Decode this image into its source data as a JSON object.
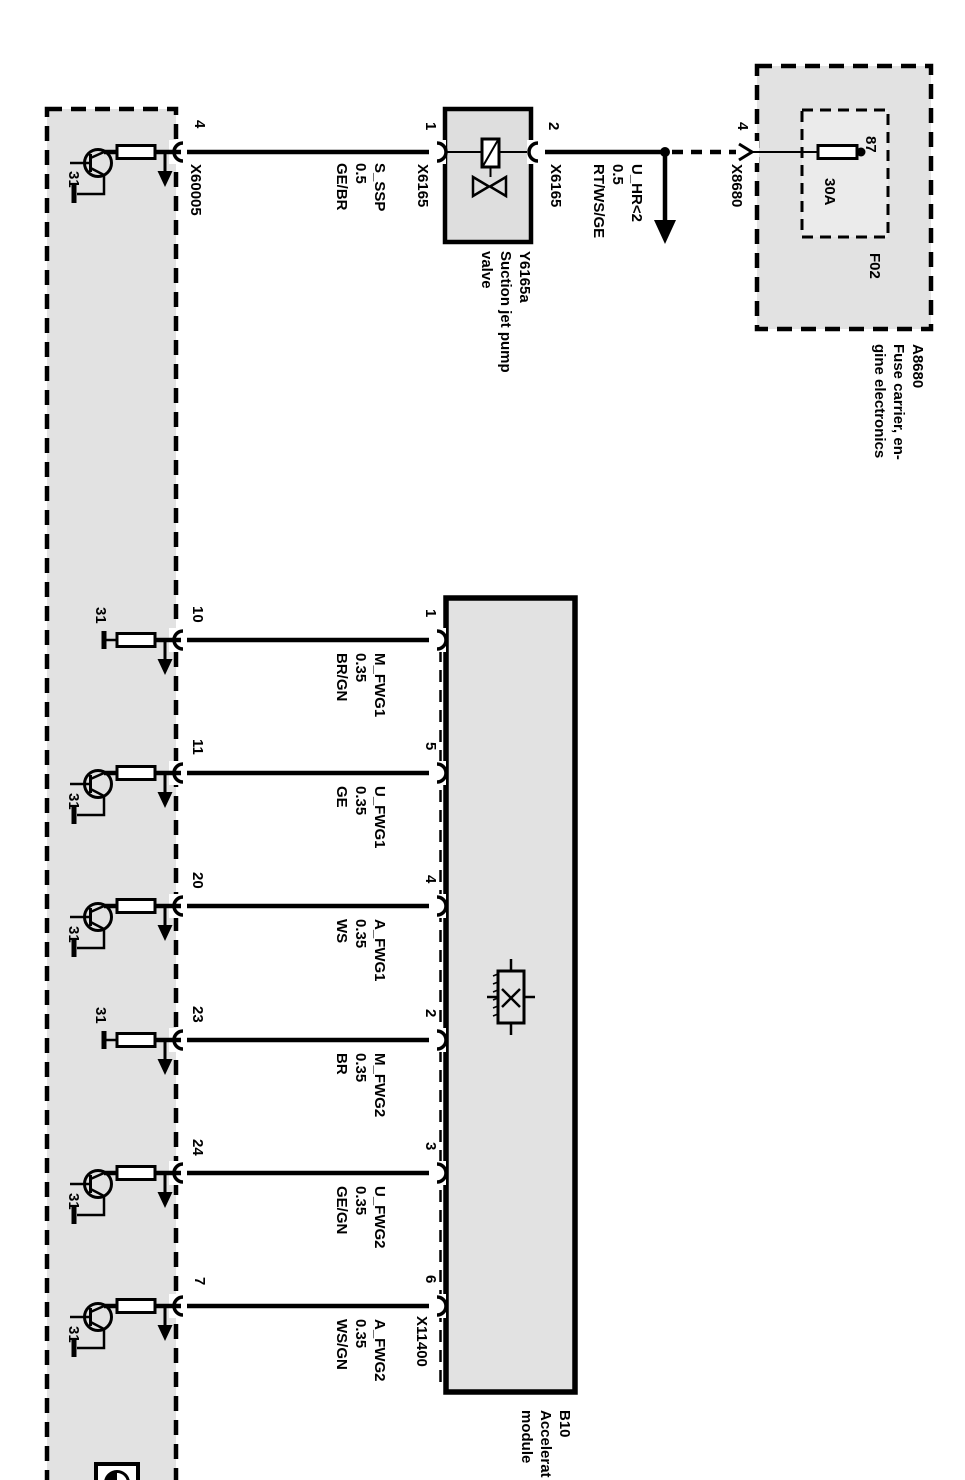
{
  "palette": {
    "background": "#ffffff",
    "line": "#000000",
    "module_fill": "#e2e2e2"
  },
  "ground_label": "31",
  "top_row": {
    "left_pin": "4",
    "left_connector": "X60005",
    "wire1": {
      "signal": "S_SSP",
      "gauge": "0.5",
      "color": "GE/BR"
    },
    "valve_pin_left": "1",
    "valve_connector_left": "X6165",
    "valve": {
      "id": "Y6165a",
      "name1": "Suction jet pump",
      "name2": "valve"
    },
    "valve_pin_right": "2",
    "valve_connector_right": "X6165",
    "wire2": {
      "signal": "U_HR<2",
      "gauge": "0.5",
      "color": "RT/WS/GE"
    },
    "fusebox_pin": "4",
    "fusebox_connector": "X8680",
    "fuse": {
      "terminal": "87",
      "rating": "30A",
      "id": "F02"
    },
    "fuse_carrier": {
      "id": "A8680",
      "name1": "Fuse carrier, en-",
      "name2": "gine electronics"
    }
  },
  "accelerator": {
    "id": "B10",
    "name1": "Accelerat",
    "name2": "module",
    "connector": "X11400",
    "rows": [
      {
        "left_pin": "10",
        "right_pin": "1",
        "signal": "M_FWG1",
        "gauge": "0.35",
        "color": "BR/GN"
      },
      {
        "left_pin": "11",
        "right_pin": "5",
        "signal": "U_FWG1",
        "gauge": "0.35",
        "color": "GE"
      },
      {
        "left_pin": "20",
        "right_pin": "4",
        "signal": "A_FWG1",
        "gauge": "0.35",
        "color": "WS"
      },
      {
        "left_pin": "23",
        "right_pin": "2",
        "signal": "M_FWG2",
        "gauge": "0.35",
        "color": "BR"
      },
      {
        "left_pin": "24",
        "right_pin": "3",
        "signal": "U_FWG2",
        "gauge": "0.35",
        "color": "GE/GN"
      },
      {
        "left_pin": "7",
        "right_pin": "6",
        "signal": "A_FWG2",
        "gauge": "0.35",
        "color": "WS/GN"
      }
    ]
  }
}
